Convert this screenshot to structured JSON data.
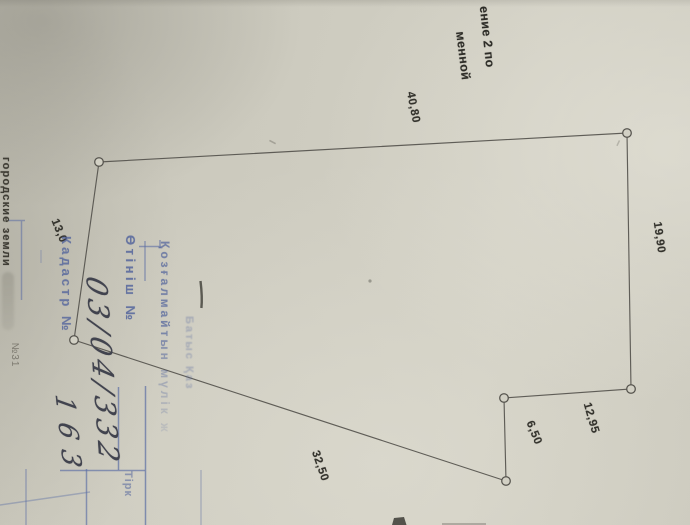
{
  "caption": {
    "line1": "ение 2 по",
    "line2": "менной"
  },
  "left_margin": {
    "label": "городские земли",
    "number": "№31"
  },
  "plan": {
    "vertices": [
      [
        99,
        162
      ],
      [
        627,
        133
      ],
      [
        631,
        389
      ],
      [
        504,
        398
      ],
      [
        506,
        481
      ],
      [
        74,
        340
      ]
    ],
    "dimension_labels": [
      {
        "text": "40,80",
        "x": 410,
        "y": 108,
        "angle": 79
      },
      {
        "text": "19,90",
        "x": 656,
        "y": 238,
        "angle": 82
      },
      {
        "text": "12,95",
        "x": 588,
        "y": 419,
        "angle": 74
      },
      {
        "text": "6,50",
        "x": 531,
        "y": 434,
        "angle": 68
      },
      {
        "text": "32,50",
        "x": 317,
        "y": 467,
        "angle": 71
      },
      {
        "text": "13,0",
        "x": 56,
        "y": 232,
        "angle": 68
      }
    ]
  },
  "stamp": {
    "org_name_faint": "Батыс Қаз",
    "property_line": "Қозғалмайтын мүлік ж",
    "application_label": "Өтініш №",
    "application_number": "03/04/332",
    "cadastre_label": "Кадастр №",
    "cadastre_number": "163",
    "registration_label": "Тірк",
    "ink_color": "#51639c"
  }
}
